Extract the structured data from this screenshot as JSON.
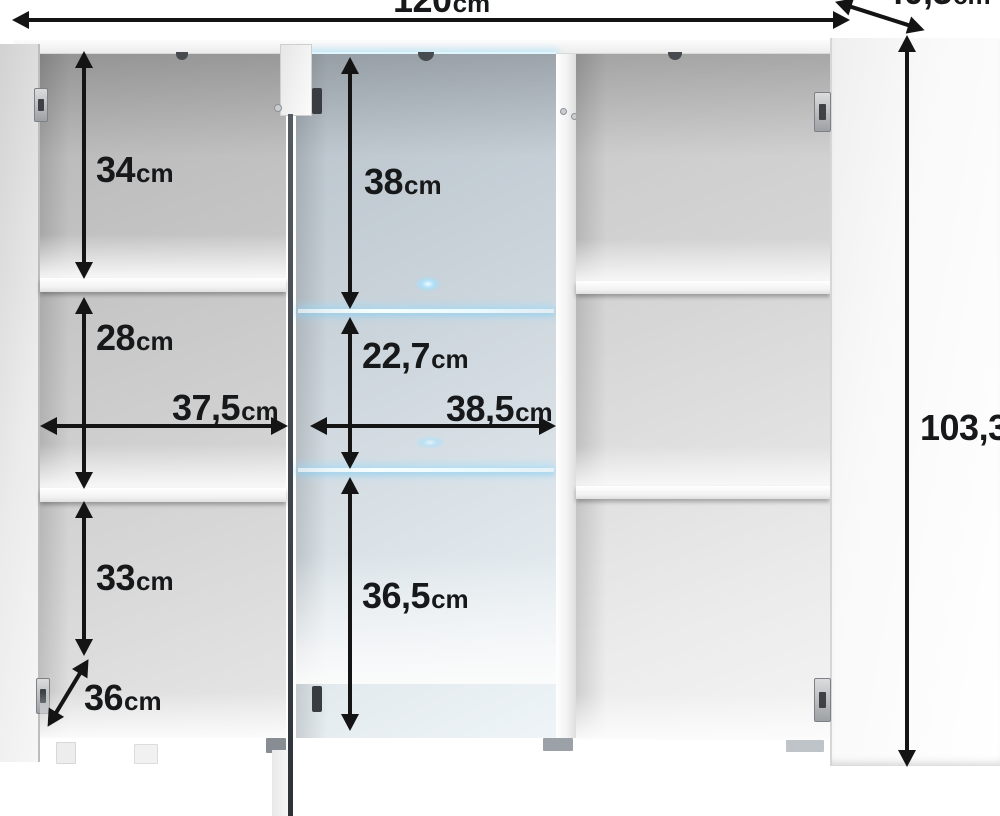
{
  "diagram": {
    "subject": "white three-door highboard cabinet shown open with interior shelf dimensions"
  },
  "dims": {
    "width": {
      "value": "120",
      "unit": "cm"
    },
    "depth": {
      "value": "40,5",
      "unit": "cm"
    },
    "height": {
      "value": "103,3",
      "unit": "cm"
    },
    "left_top": {
      "value": "34",
      "unit": "cm"
    },
    "left_middle": {
      "value": "28",
      "unit": "cm"
    },
    "left_width": {
      "value": "37,5",
      "unit": "cm"
    },
    "left_bottom": {
      "value": "33",
      "unit": "cm"
    },
    "interior_depth": {
      "value": "36",
      "unit": "cm"
    },
    "mid_top": {
      "value": "38",
      "unit": "cm"
    },
    "mid_middle": {
      "value": "22,7",
      "unit": "cm"
    },
    "mid_width": {
      "value": "38,5",
      "unit": "cm"
    },
    "mid_bottom": {
      "value": "36,5",
      "unit": "cm"
    }
  },
  "colors": {
    "arrow": "#141414",
    "led_glow": "#9fdfff",
    "interior_gray": "#c6c6c6",
    "interior_blue": "#cdd6dc"
  }
}
